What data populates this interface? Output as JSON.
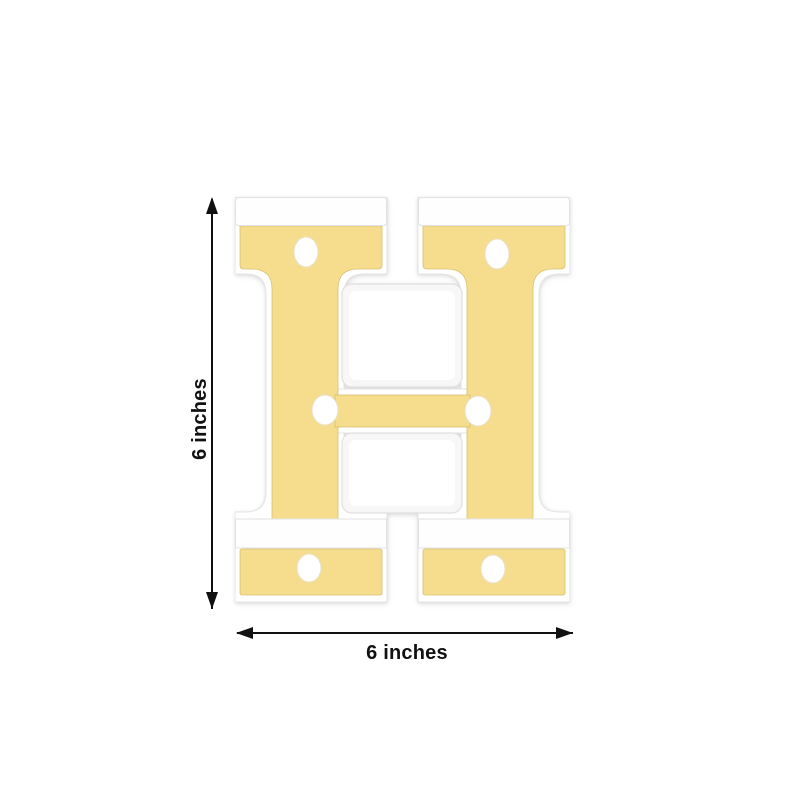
{
  "figure": {
    "letter": "H",
    "led_count": 6,
    "style": "3D marquee letter light, gold face with white frame and round LED bulbs"
  },
  "dimensions": {
    "height_label": "6 inches",
    "width_label": "6 inches"
  },
  "colors": {
    "gold_face": "#F5DD8D",
    "gold_edge": "#D8C06F",
    "frame_white": "#FFFFFF",
    "frame_edge": "#E3E3E3",
    "counter_wall": "#F7F7F7",
    "led_white": "#FFFFFF",
    "annotation": "#111111",
    "background": "#FFFFFF"
  },
  "icons": {
    "arrow_up": "css-triangle-up",
    "arrow_down": "css-triangle-down",
    "arrow_left": "css-triangle-left",
    "arrow_right": "css-triangle-right"
  }
}
